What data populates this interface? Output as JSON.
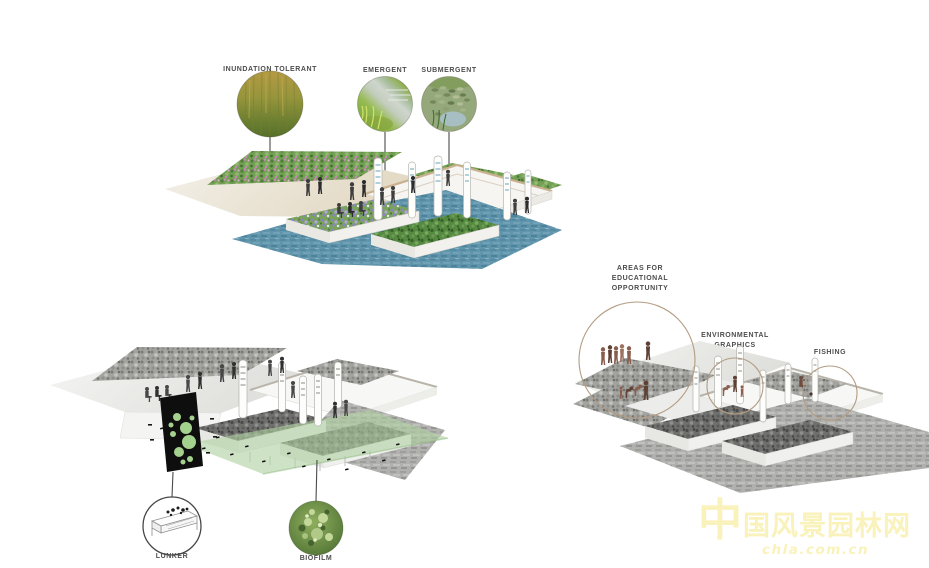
{
  "diagrams": {
    "planting_types": {
      "callouts": [
        {
          "label": "INUNDATION TOLERANT",
          "image": "inundation-grasses-photo"
        },
        {
          "label": "EMERGENT",
          "image": "emergent-plants-photo"
        },
        {
          "label": "SUBMERGENT",
          "image": "submergent-lilypads-photo"
        }
      ]
    },
    "water_habitat": {
      "callouts": [
        {
          "label": "LUNKER",
          "image": "lunker-structure-sketch"
        },
        {
          "label": "BIOFILM",
          "image": "biofilm-photo"
        }
      ]
    },
    "program_areas": {
      "callouts": [
        {
          "lines": [
            "AREAS FOR",
            "EDUCATIONAL",
            "OPPORTUNITY"
          ]
        },
        {
          "lines": [
            "ENVIRONMENTAL",
            "GRAPHICS"
          ]
        },
        {
          "lines": [
            "FISHING"
          ]
        }
      ]
    }
  },
  "watermark": {
    "site_name": "中国风景园林网",
    "site_url": "chla.com.cn"
  },
  "colors": {
    "label_text": "#4d4d4d",
    "callout_ring_tan": "#b39c82",
    "water_blue": "#6095ac",
    "biofilm_green": "#b0d0a2",
    "lunker_bubble_green": "#a5d18e",
    "watermark_yellow": "#faf2bb"
  }
}
